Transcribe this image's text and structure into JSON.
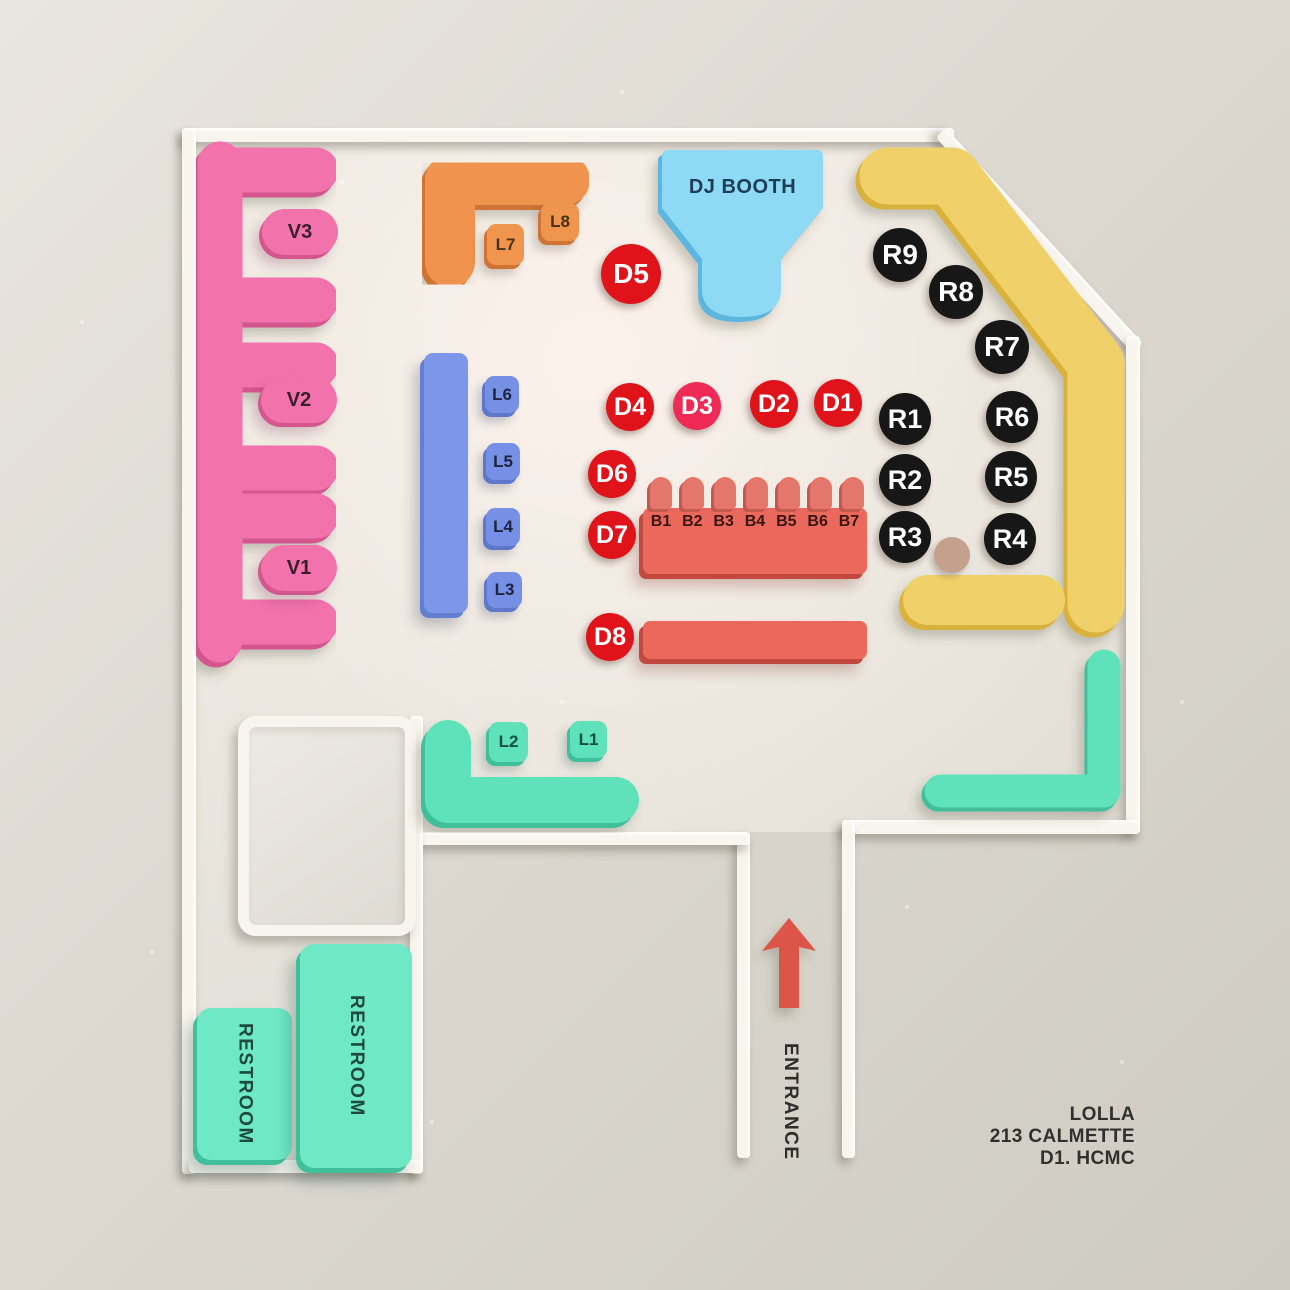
{
  "venue": {
    "name": "LOLLA",
    "address": [
      "213 CALMETTE",
      "D1. HCMC"
    ]
  },
  "areas": {
    "dj_booth": "DJ BOOTH",
    "entrance": "ENTRANCE",
    "restrooms": [
      "RESTROOM",
      "RESTROOM"
    ]
  },
  "seats": {
    "v_booths": [
      "V3",
      "V2",
      "V1"
    ],
    "lounge": [
      "L8",
      "L7",
      "L6",
      "L5",
      "L4",
      "L3",
      "L2",
      "L1"
    ],
    "d_tables": [
      "D5",
      "D4",
      "D3",
      "D2",
      "D1",
      "D6",
      "D7",
      "D8"
    ],
    "r_tables": [
      "R9",
      "R8",
      "R7",
      "R1",
      "R6",
      "R2",
      "R5",
      "R3",
      "R4"
    ],
    "bar_seats": [
      "B1",
      "B2",
      "B3",
      "B4",
      "B5",
      "B6",
      "B7"
    ]
  },
  "colors": {
    "vip_pink": "#f272ac",
    "lounge_orange": "#ef934f",
    "dj_blue": "#8ed9f3",
    "bench_blue": "#7d97e8",
    "rail_yellow": "#f0d169",
    "table_red": "#df1319",
    "table_red_alt": "#ee2a55",
    "bar_coral": "#ea685c",
    "seat_black": "#171717",
    "lounge_teal": "#5fe2ba",
    "restroom_mint": "#6fe9c5",
    "arrow_red": "#dd544a"
  }
}
